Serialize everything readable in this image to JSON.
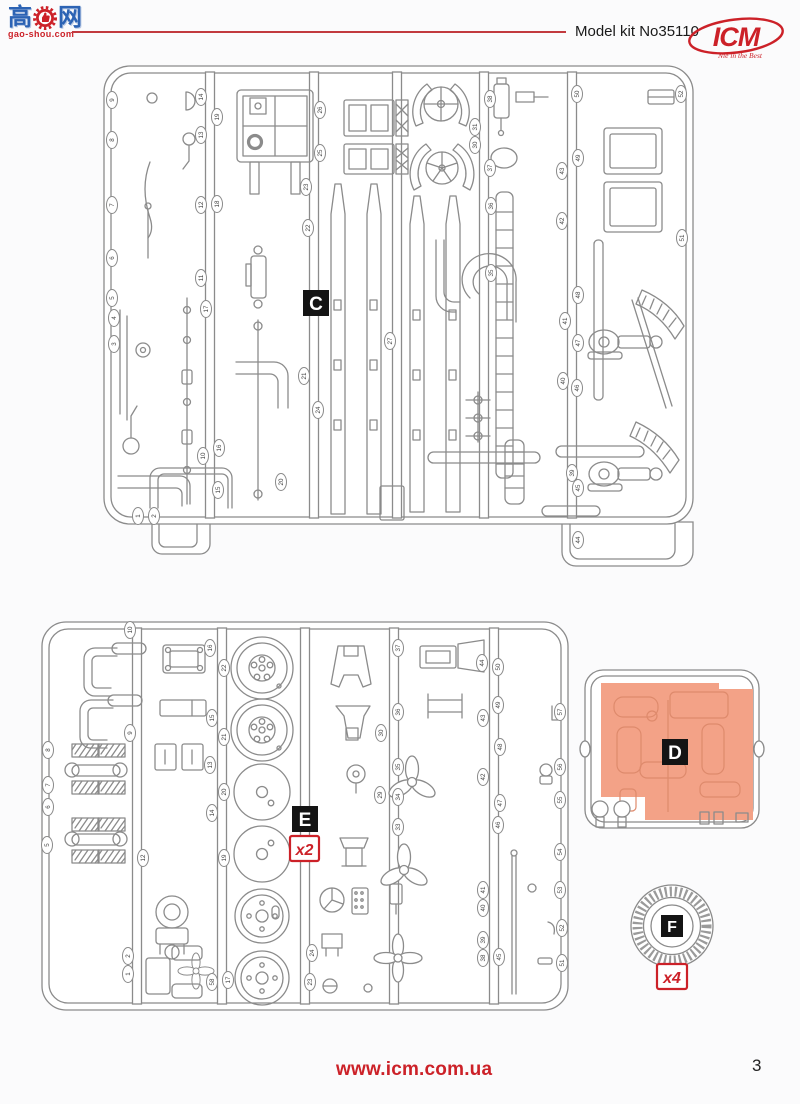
{
  "watermark": {
    "char_left": "高",
    "char_right": "网",
    "domain": "gao-shou.com"
  },
  "header": {
    "kit_label": "Model kit No35110",
    "brand": "ICM",
    "brand_tagline": "Nie in the Best"
  },
  "footer": {
    "url": "www.icm.com.ua",
    "page_number": "3"
  },
  "colors": {
    "red": "#cc2128",
    "sprue_gray": "#8b8b8b",
    "highlight_orange": "#f3a287",
    "highlight_outline": "#de8a6c",
    "label_bg": "#141414"
  },
  "sprues": {
    "c": {
      "label": "C",
      "tags": [
        {
          "n": 9,
          "x": 112,
          "y": 100
        },
        {
          "n": 8,
          "x": 112,
          "y": 140
        },
        {
          "n": 7,
          "x": 112,
          "y": 205
        },
        {
          "n": 6,
          "x": 112,
          "y": 258
        },
        {
          "n": 5,
          "x": 112,
          "y": 298
        },
        {
          "n": 4,
          "x": 114,
          "y": 318
        },
        {
          "n": 3,
          "x": 114,
          "y": 344
        },
        {
          "n": 1,
          "x": 138,
          "y": 516
        },
        {
          "n": 2,
          "x": 154,
          "y": 516
        },
        {
          "n": 14,
          "x": 201,
          "y": 97
        },
        {
          "n": 13,
          "x": 201,
          "y": 135
        },
        {
          "n": 12,
          "x": 201,
          "y": 205
        },
        {
          "n": 11,
          "x": 201,
          "y": 278
        },
        {
          "n": 17,
          "x": 206,
          "y": 309
        },
        {
          "n": 10,
          "x": 203,
          "y": 456
        },
        {
          "n": 16,
          "x": 219,
          "y": 448
        },
        {
          "n": 15,
          "x": 218,
          "y": 490
        },
        {
          "n": 19,
          "x": 217,
          "y": 117
        },
        {
          "n": 18,
          "x": 217,
          "y": 204
        },
        {
          "n": 26,
          "x": 320,
          "y": 110
        },
        {
          "n": 25,
          "x": 320,
          "y": 153
        },
        {
          "n": 23,
          "x": 306,
          "y": 187
        },
        {
          "n": 22,
          "x": 308,
          "y": 228
        },
        {
          "n": 21,
          "x": 304,
          "y": 376
        },
        {
          "n": 24,
          "x": 318,
          "y": 410
        },
        {
          "n": 20,
          "x": 281,
          "y": 482
        },
        {
          "n": 27,
          "x": 390,
          "y": 341
        },
        {
          "n": 31,
          "x": 475,
          "y": 127
        },
        {
          "n": 30,
          "x": 475,
          "y": 145
        },
        {
          "n": 38,
          "x": 490,
          "y": 99
        },
        {
          "n": 37,
          "x": 490,
          "y": 168
        },
        {
          "n": 36,
          "x": 491,
          "y": 206
        },
        {
          "n": 35,
          "x": 491,
          "y": 273
        },
        {
          "n": 50,
          "x": 577,
          "y": 94
        },
        {
          "n": 49,
          "x": 578,
          "y": 158
        },
        {
          "n": 43,
          "x": 562,
          "y": 171
        },
        {
          "n": 42,
          "x": 562,
          "y": 221
        },
        {
          "n": 48,
          "x": 578,
          "y": 295
        },
        {
          "n": 41,
          "x": 565,
          "y": 321
        },
        {
          "n": 47,
          "x": 578,
          "y": 343
        },
        {
          "n": 40,
          "x": 563,
          "y": 381
        },
        {
          "n": 46,
          "x": 577,
          "y": 388
        },
        {
          "n": 39,
          "x": 572,
          "y": 473
        },
        {
          "n": 45,
          "x": 578,
          "y": 488
        },
        {
          "n": 44,
          "x": 578,
          "y": 540
        },
        {
          "n": 52,
          "x": 681,
          "y": 94
        },
        {
          "n": 51,
          "x": 682,
          "y": 238
        }
      ]
    },
    "d": {
      "label": "D"
    },
    "e": {
      "label": "E",
      "quantity": "x2",
      "tags": [
        {
          "n": 8,
          "x": 48,
          "y": 750
        },
        {
          "n": 7,
          "x": 48,
          "y": 785
        },
        {
          "n": 6,
          "x": 48,
          "y": 807
        },
        {
          "n": 5,
          "x": 47,
          "y": 845
        },
        {
          "n": 10,
          "x": 130,
          "y": 630
        },
        {
          "n": 9,
          "x": 130,
          "y": 733
        },
        {
          "n": 12,
          "x": 143,
          "y": 858
        },
        {
          "n": 2,
          "x": 128,
          "y": 956
        },
        {
          "n": 1,
          "x": 128,
          "y": 974
        },
        {
          "n": 16,
          "x": 210,
          "y": 648
        },
        {
          "n": 22,
          "x": 224,
          "y": 668
        },
        {
          "n": 15,
          "x": 212,
          "y": 718
        },
        {
          "n": 21,
          "x": 224,
          "y": 737
        },
        {
          "n": 13,
          "x": 210,
          "y": 765
        },
        {
          "n": 20,
          "x": 224,
          "y": 792
        },
        {
          "n": 14,
          "x": 212,
          "y": 813
        },
        {
          "n": 19,
          "x": 224,
          "y": 858
        },
        {
          "n": 58,
          "x": 212,
          "y": 982
        },
        {
          "n": 17,
          "x": 228,
          "y": 980
        },
        {
          "n": 24,
          "x": 312,
          "y": 953
        },
        {
          "n": 23,
          "x": 310,
          "y": 982
        },
        {
          "n": 37,
          "x": 398,
          "y": 648
        },
        {
          "n": 36,
          "x": 398,
          "y": 712
        },
        {
          "n": 30,
          "x": 381,
          "y": 733
        },
        {
          "n": 35,
          "x": 398,
          "y": 767
        },
        {
          "n": 29,
          "x": 380,
          "y": 795
        },
        {
          "n": 34,
          "x": 398,
          "y": 797
        },
        {
          "n": 33,
          "x": 398,
          "y": 827
        },
        {
          "n": 44,
          "x": 482,
          "y": 663
        },
        {
          "n": 50,
          "x": 498,
          "y": 667
        },
        {
          "n": 49,
          "x": 498,
          "y": 705
        },
        {
          "n": 43,
          "x": 483,
          "y": 718
        },
        {
          "n": 48,
          "x": 500,
          "y": 747
        },
        {
          "n": 42,
          "x": 483,
          "y": 777
        },
        {
          "n": 47,
          "x": 500,
          "y": 803
        },
        {
          "n": 46,
          "x": 498,
          "y": 825
        },
        {
          "n": 41,
          "x": 483,
          "y": 890
        },
        {
          "n": 40,
          "x": 483,
          "y": 908
        },
        {
          "n": 39,
          "x": 483,
          "y": 940
        },
        {
          "n": 38,
          "x": 483,
          "y": 958
        },
        {
          "n": 45,
          "x": 499,
          "y": 957
        },
        {
          "n": 57,
          "x": 560,
          "y": 712
        },
        {
          "n": 56,
          "x": 560,
          "y": 767
        },
        {
          "n": 55,
          "x": 560,
          "y": 800
        },
        {
          "n": 54,
          "x": 560,
          "y": 852
        },
        {
          "n": 53,
          "x": 560,
          "y": 890
        },
        {
          "n": 52,
          "x": 562,
          "y": 928
        },
        {
          "n": 51,
          "x": 562,
          "y": 963
        }
      ]
    },
    "f": {
      "label": "F",
      "quantity": "x4"
    }
  }
}
